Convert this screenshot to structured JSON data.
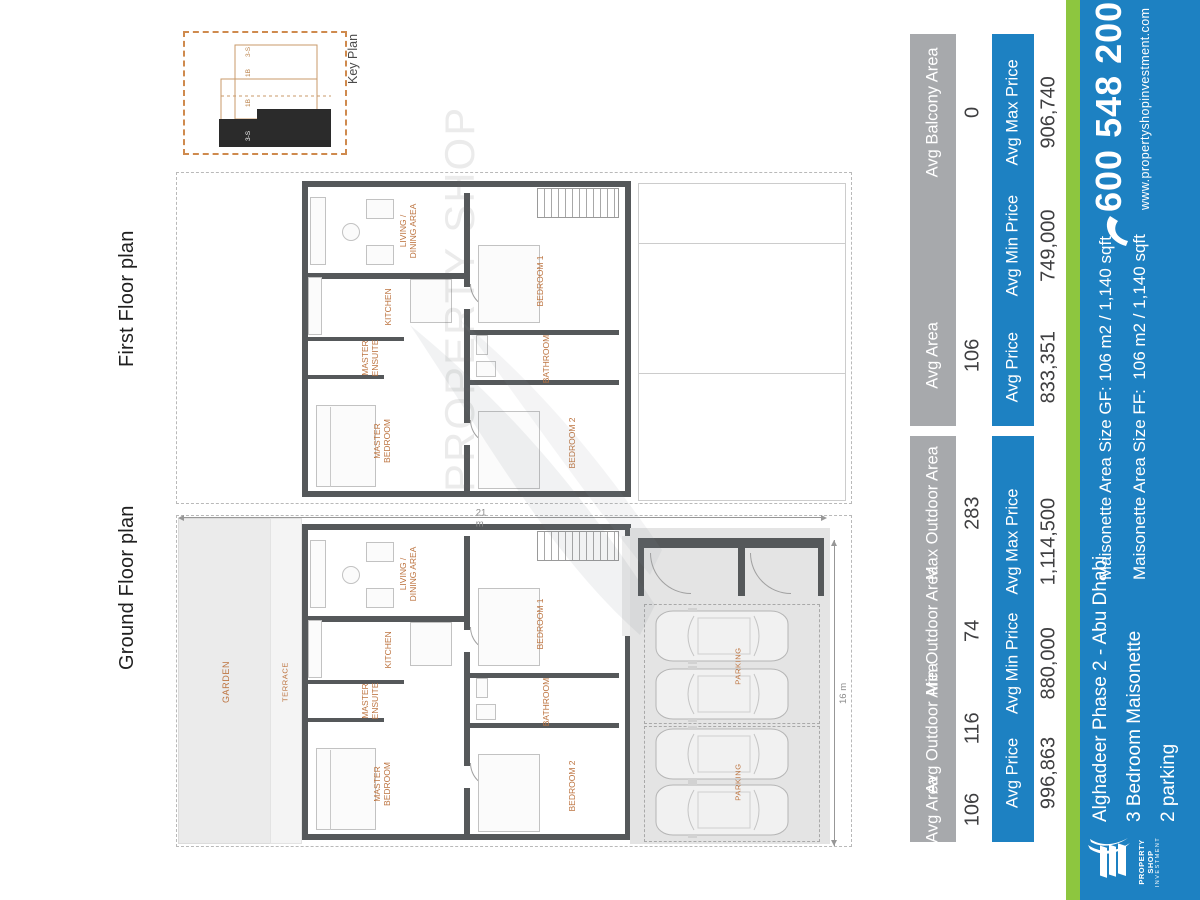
{
  "headings": {
    "ground": "Ground Floor plan",
    "first": "First Floor plan"
  },
  "key_plan": {
    "caption": "Key Plan",
    "unit_labels": [
      "3-S",
      "1B",
      "1B",
      "3-S"
    ]
  },
  "watermark_text": "PROPERTY SHOP",
  "room_labels": {
    "living_line1": "LIVING /",
    "living_line2": "DINING AREA",
    "kitchen": "KITCHEN",
    "ensuite_line1": "MASTER",
    "ensuite_line2": "ENSUITE",
    "master_line1": "MASTER",
    "master_line2": "BEDROOM",
    "bedroom1": "BEDROOM 1",
    "bathroom": "BATHROOM",
    "bedroom2": "BEDROOM 2"
  },
  "ground_plan": {
    "garden": "GARDEN",
    "terrace": "TERRACE",
    "parking1": "PARKING",
    "parking2": "PARKING",
    "dim_vertical": "21 m",
    "dim_horizontal": "16 m"
  },
  "tables": {
    "ground": {
      "area_headers": [
        "Avg Area",
        "Avg Outdoor Area",
        "Min Outdoor Area",
        "Max Outdoor Area"
      ],
      "area_values": [
        "106",
        "116",
        "74",
        "283"
      ],
      "price_headers": [
        "Avg Price",
        "Avg Min Price",
        "Avg Max Price"
      ],
      "price_values": [
        "996,863",
        "880,000",
        "1,114,500"
      ]
    },
    "first": {
      "area_headers": [
        "Avg Area",
        "Avg Balcony Area"
      ],
      "area_values": [
        "106",
        "0"
      ],
      "price_headers": [
        "Avg Price",
        "Avg Min Price",
        "Avg Max Price"
      ],
      "price_values": [
        "833,351",
        "749,000",
        "906,740"
      ]
    }
  },
  "footer": {
    "logo": {
      "name_line1": "PROPERTY SHOP",
      "name_line2": "INVESTMENT"
    },
    "project_lines": [
      "Alghadeer Phase 2 - Abu Dhabi",
      "3 Bedroom Maisonette",
      "2 parking"
    ],
    "size_lines": [
      "Maisonette Area Size GF: 106 m2 / 1,140 sqft",
      "Maisonette Area Size FF:  106 m2 / 1,140 sqft"
    ],
    "phone": "600 548 200",
    "website": "www.propertyshopinvestment.com"
  },
  "colors": {
    "blue": "#1d81c2",
    "green": "#8dc63f",
    "gray": "#a7a9ac",
    "orange": "#bd7440",
    "wall": "#55585a"
  }
}
